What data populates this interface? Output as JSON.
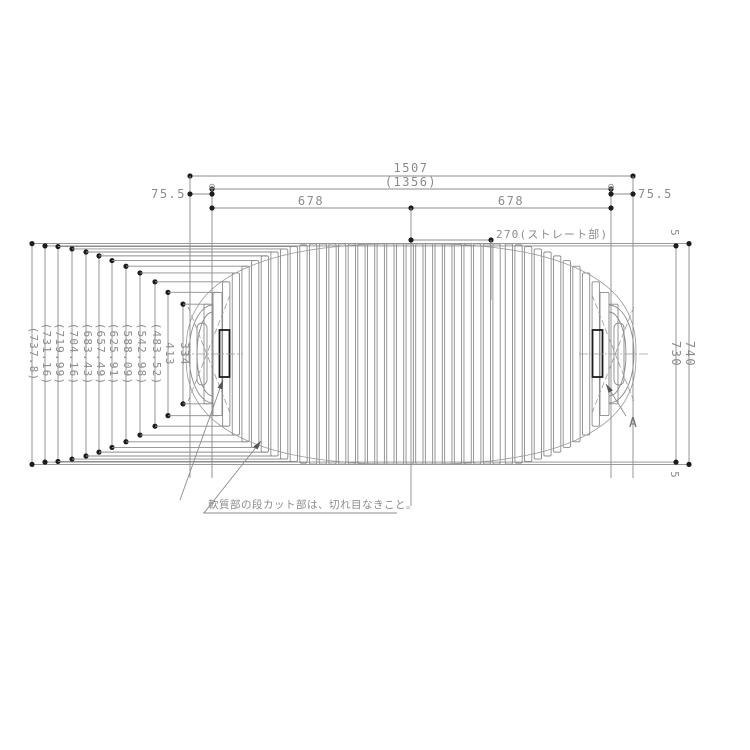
{
  "drawing": {
    "dimensions": {
      "overall_length": "1507",
      "inner_length": "(1356)",
      "half_left": "678",
      "half_right": "678",
      "straight_section": "270(ストレート部)",
      "end_offset_left": "75.5",
      "end_offset_right": "75.5",
      "body_width": "730",
      "overall_width": "740",
      "edge_gap_top": "5",
      "edge_gap_bottom": "5"
    },
    "chord_labels": [
      "(737.8)",
      "(731.16)",
      "(719.99)",
      "(704.16)",
      "(683.43)",
      "(657.49)",
      "(625.91)",
      "(588.09)",
      "(542.98)",
      "(483.52)",
      "413",
      "334"
    ],
    "chord_values_mm": [
      737.8,
      731.16,
      719.99,
      704.16,
      683.43,
      657.49,
      625.91,
      588.09,
      542.98,
      483.52,
      413,
      334
    ],
    "note": "軟質部の段カット部は、切れ目なきこと。",
    "detail_label": "A",
    "colors": {
      "background": "#ffffff",
      "line": "#8b8b8b",
      "dark": "#1c1c1c",
      "text": "#8b8b8b"
    }
  }
}
